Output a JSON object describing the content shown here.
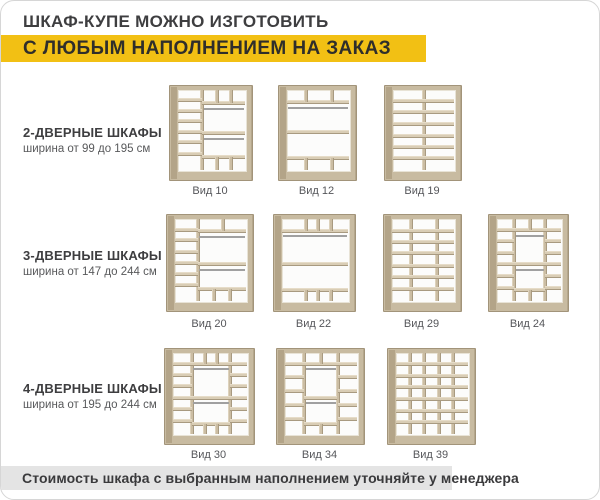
{
  "page": {
    "title": "ШКАФ-КУПЕ МОЖНО ИЗГОТОВИТЬ",
    "banner": "С ЛЮБЫМ НАПОЛНЕНИЕМ НА ЗАКАЗ",
    "footer": "Стоимость шкафа с выбранным наполнением уточняйте у менеджера",
    "accent_yellow": "#f2c014",
    "footer_gray": "#e4e4e4",
    "wood_color": "#c8bba1"
  },
  "rows": [
    {
      "heading": "2-ДВЕРНЫЕ ШКАФЫ",
      "subtitle": "ширина от 99 до 195 см",
      "label_y": 184,
      "items": [
        {
          "label": "Вид 10",
          "x": 168,
          "y": 84,
          "w": 82,
          "h": 94,
          "parts": [
            [
              "v",
              0.36,
              0,
              1
            ],
            [
              "h",
              0.13,
              0,
              0.36
            ],
            [
              "h",
              0.26,
              0,
              0.36
            ],
            [
              "h",
              0.39,
              0,
              0.36
            ],
            [
              "h",
              0.52,
              0,
              0.36
            ],
            [
              "h",
              0.65,
              0,
              0.36
            ],
            [
              "h",
              0.8,
              0,
              0.36
            ],
            [
              "h",
              0.16,
              0.36,
              1
            ],
            [
              "v",
              0.58,
              0,
              0.16
            ],
            [
              "v",
              0.79,
              0,
              0.16
            ],
            [
              "r",
              0.22,
              0.38,
              0.99
            ],
            [
              "h",
              0.54,
              0.36,
              1
            ],
            [
              "r",
              0.6,
              0.38,
              0.99
            ],
            [
              "h",
              0.84,
              0.36,
              1
            ],
            [
              "v",
              0.58,
              0.84,
              1
            ],
            [
              "v",
              0.79,
              0.84,
              1
            ]
          ]
        },
        {
          "label": "Вид 12",
          "x": 277,
          "y": 84,
          "w": 77,
          "h": 94,
          "parts": [
            [
              "h",
              0.15,
              0,
              1
            ],
            [
              "v",
              0.3,
              0,
              0.15
            ],
            [
              "v",
              0.72,
              0,
              0.15
            ],
            [
              "r",
              0.21,
              0.02,
              0.98
            ],
            [
              "h",
              0.53,
              0,
              1
            ],
            [
              "h",
              0.85,
              0,
              1
            ],
            [
              "v",
              0.3,
              0.85,
              1
            ],
            [
              "v",
              0.72,
              0.85,
              1
            ]
          ]
        },
        {
          "label": "Вид 19",
          "x": 383,
          "y": 84,
          "w": 76,
          "h": 94,
          "parts": [
            [
              "v",
              0.5,
              0,
              1
            ],
            [
              "h",
              0.14,
              0,
              1
            ],
            [
              "h",
              0.28,
              0,
              1
            ],
            [
              "h",
              0.42,
              0,
              1
            ],
            [
              "h",
              0.57,
              0,
              1
            ],
            [
              "h",
              0.71,
              0,
              1
            ],
            [
              "h",
              0.85,
              0,
              1
            ]
          ]
        }
      ]
    },
    {
      "heading": "3-ДВЕРНЫЕ ШКАФЫ",
      "subtitle": "ширина от 147 до 244 см",
      "label_y": 317,
      "items": [
        {
          "label": "Вид 20",
          "x": 165,
          "y": 213,
          "w": 86,
          "h": 96,
          "parts": [
            [
              "v",
              0.32,
              0,
              1
            ],
            [
              "h",
              0.13,
              0,
              0.32
            ],
            [
              "h",
              0.26,
              0,
              0.32
            ],
            [
              "h",
              0.4,
              0,
              0.32
            ],
            [
              "h",
              0.54,
              0,
              0.32
            ],
            [
              "h",
              0.67,
              0,
              0.32
            ],
            [
              "h",
              0.81,
              0,
              0.32
            ],
            [
              "h",
              0.15,
              0.32,
              1
            ],
            [
              "v",
              0.68,
              0,
              0.15
            ],
            [
              "r",
              0.21,
              0.34,
              0.99
            ],
            [
              "h",
              0.55,
              0.32,
              1
            ],
            [
              "r",
              0.61,
              0.34,
              0.99
            ],
            [
              "h",
              0.85,
              0.32,
              1
            ],
            [
              "v",
              0.55,
              0.85,
              1
            ],
            [
              "v",
              0.78,
              0.85,
              1
            ]
          ]
        },
        {
          "label": "Вид 22",
          "x": 272,
          "y": 213,
          "w": 81,
          "h": 96,
          "parts": [
            [
              "h",
              0.14,
              0,
              1
            ],
            [
              "v",
              0.36,
              0,
              0.14
            ],
            [
              "v",
              0.55,
              0,
              0.14
            ],
            [
              "v",
              0.74,
              0,
              0.14
            ],
            [
              "r",
              0.2,
              0.02,
              0.98
            ],
            [
              "h",
              0.55,
              0,
              1
            ],
            [
              "h",
              0.86,
              0,
              1
            ],
            [
              "v",
              0.36,
              0.86,
              1
            ],
            [
              "v",
              0.55,
              0.86,
              1
            ],
            [
              "v",
              0.74,
              0.86,
              1
            ]
          ]
        },
        {
          "label": "Вид 29",
          "x": 382,
          "y": 213,
          "w": 77,
          "h": 96,
          "parts": [
            [
              "v",
              0.3,
              0,
              1
            ],
            [
              "v",
              0.72,
              0,
              1
            ],
            [
              "h",
              0.14,
              0,
              1
            ],
            [
              "h",
              0.28,
              0,
              1
            ],
            [
              "h",
              0.42,
              0,
              1
            ],
            [
              "h",
              0.57,
              0,
              1
            ],
            [
              "h",
              0.71,
              0,
              1
            ],
            [
              "h",
              0.85,
              0,
              1
            ]
          ]
        },
        {
          "label": "Вид 24",
          "x": 487,
          "y": 213,
          "w": 79,
          "h": 96,
          "parts": [
            [
              "v",
              0.27,
              0,
              1
            ],
            [
              "v",
              0.75,
              0,
              1
            ],
            [
              "h",
              0.13,
              0,
              0.27
            ],
            [
              "h",
              0.27,
              0,
              0.27
            ],
            [
              "h",
              0.41,
              0,
              0.27
            ],
            [
              "h",
              0.55,
              0,
              0.27
            ],
            [
              "h",
              0.69,
              0,
              0.27
            ],
            [
              "h",
              0.84,
              0,
              0.27
            ],
            [
              "h",
              0.13,
              0.75,
              1
            ],
            [
              "h",
              0.27,
              0.75,
              1
            ],
            [
              "h",
              0.41,
              0.75,
              1
            ],
            [
              "h",
              0.55,
              0.75,
              1
            ],
            [
              "h",
              0.69,
              0.75,
              1
            ],
            [
              "h",
              0.84,
              0.75,
              1
            ],
            [
              "h",
              0.13,
              0.27,
              0.75
            ],
            [
              "v",
              0.51,
              0,
              0.13
            ],
            [
              "r",
              0.19,
              0.29,
              0.73
            ],
            [
              "h",
              0.55,
              0.27,
              0.75
            ],
            [
              "r",
              0.61,
              0.29,
              0.73
            ],
            [
              "h",
              0.86,
              0.27,
              0.75
            ],
            [
              "v",
              0.51,
              0.86,
              1
            ]
          ]
        }
      ]
    },
    {
      "heading": "4-ДВЕРНЫЕ ШКАФЫ",
      "subtitle": "ширина от 195 до 244 см",
      "label_y": 448,
      "items": [
        {
          "label": "Вид 30",
          "x": 163,
          "y": 347,
          "w": 89,
          "h": 95,
          "parts": [
            [
              "v",
              0.25,
              0,
              1
            ],
            [
              "v",
              0.77,
              0,
              1
            ],
            [
              "h",
              0.13,
              0,
              0.25
            ],
            [
              "h",
              0.27,
              0,
              0.25
            ],
            [
              "h",
              0.41,
              0,
              0.25
            ],
            [
              "h",
              0.55,
              0,
              0.25
            ],
            [
              "h",
              0.69,
              0,
              0.25
            ],
            [
              "h",
              0.84,
              0,
              0.25
            ],
            [
              "h",
              0.13,
              0.77,
              1
            ],
            [
              "h",
              0.27,
              0.77,
              1
            ],
            [
              "h",
              0.41,
              0.77,
              1
            ],
            [
              "h",
              0.55,
              0.77,
              1
            ],
            [
              "h",
              0.69,
              0.77,
              1
            ],
            [
              "h",
              0.84,
              0.77,
              1
            ],
            [
              "h",
              0.13,
              0.25,
              0.77
            ],
            [
              "v",
              0.43,
              0,
              0.13
            ],
            [
              "v",
              0.6,
              0,
              0.13
            ],
            [
              "r",
              0.19,
              0.27,
              0.75
            ],
            [
              "h",
              0.55,
              0.25,
              0.77
            ],
            [
              "r",
              0.61,
              0.27,
              0.75
            ],
            [
              "h",
              0.87,
              0.25,
              0.77
            ],
            [
              "v",
              0.43,
              0.87,
              1
            ],
            [
              "v",
              0.6,
              0.87,
              1
            ]
          ]
        },
        {
          "label": "Вид 34",
          "x": 275,
          "y": 347,
          "w": 87,
          "h": 95,
          "parts": [
            [
              "v",
              0.27,
              0,
              1
            ],
            [
              "v",
              0.73,
              0,
              1
            ],
            [
              "h",
              0.13,
              0,
              1
            ],
            [
              "v",
              0.5,
              0,
              0.13
            ],
            [
              "h",
              0.3,
              0,
              0.27
            ],
            [
              "h",
              0.47,
              0,
              0.27
            ],
            [
              "h",
              0.64,
              0,
              0.27
            ],
            [
              "h",
              0.81,
              0,
              0.27
            ],
            [
              "h",
              0.3,
              0.73,
              1
            ],
            [
              "h",
              0.47,
              0.73,
              1
            ],
            [
              "h",
              0.64,
              0.73,
              1
            ],
            [
              "h",
              0.81,
              0.73,
              1
            ],
            [
              "r",
              0.19,
              0.29,
              0.71
            ],
            [
              "h",
              0.55,
              0.27,
              0.73
            ],
            [
              "r",
              0.61,
              0.29,
              0.71
            ],
            [
              "h",
              0.87,
              0.27,
              0.73
            ],
            [
              "v",
              0.5,
              0.87,
              1
            ]
          ]
        },
        {
          "label": "Вид 39",
          "x": 386,
          "y": 347,
          "w": 87,
          "h": 95,
          "parts": [
            [
              "v",
              0.19,
              0,
              1
            ],
            [
              "v",
              0.39,
              0,
              1
            ],
            [
              "v",
              0.59,
              0,
              1
            ],
            [
              "v",
              0.79,
              0,
              1
            ],
            [
              "h",
              0.14,
              0,
              1
            ],
            [
              "h",
              0.28,
              0,
              1
            ],
            [
              "h",
              0.42,
              0,
              1
            ],
            [
              "h",
              0.57,
              0,
              1
            ],
            [
              "h",
              0.71,
              0,
              1
            ],
            [
              "h",
              0.85,
              0,
              1
            ]
          ]
        }
      ]
    }
  ]
}
